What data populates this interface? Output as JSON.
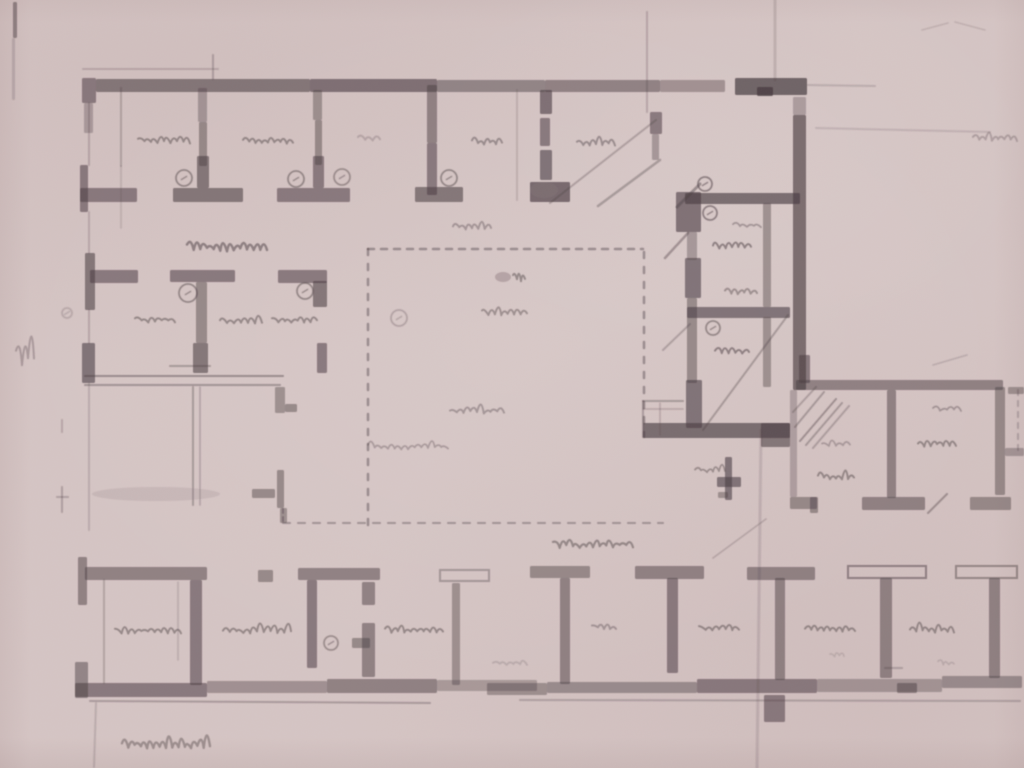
{
  "document": {
    "description": "Faded scanned pencil-and-ink architectural floor plan on pink-tinted paper: a top row of small rooms along a heavy top wall, a gallery corridor, a large central hall outlined with dashed lines, a dark-walled stair/corridor block at right with three small rooms, a right wing of rooms, and a long bottom row of rooms separated by T-shaped pier walls; all handwritten room labels and the lower-left caption are illegible cursive pencil",
    "handwriting_legible": false,
    "caption_note": "illegible cursive title at lower left",
    "label_note": "illegible cursive room labels and circled door symbols throughout"
  },
  "palette": {
    "paper": "#d6c6c5",
    "ink": "#4a3d42",
    "pencil": "#8d7b7e"
  },
  "drawing": {
    "format": {
      "walls": "[x,y,w,h,opacity] filled wall segment",
      "hollow_bars": "[x,y,w,h,opacity] outlined pier bar",
      "lines": "[x1,y1,x2,y2,strokeWidth,opacity] pencil/ink line",
      "dashed_lines": "[x1,y1,x2,y2,strokeWidth,opacity,dash,gap]",
      "circles": "[cx,cy,r,opacity] circled symbol",
      "scribbles": "[x,baselineY,width,height,seed,opacity,strokeWidth] illegible cursive",
      "smudges": "[cx,cy,rx,ry,opacity]"
    },
    "walls": [
      [
        82,
        78,
        14,
        25,
        0.55
      ],
      [
        96,
        79,
        214,
        13,
        0.58
      ],
      [
        310,
        79,
        127,
        13,
        0.62
      ],
      [
        437,
        80,
        108,
        12,
        0.48
      ],
      [
        545,
        80,
        115,
        12,
        0.5
      ],
      [
        660,
        80,
        65,
        12,
        0.38
      ],
      [
        735,
        78,
        72,
        17,
        0.72
      ],
      [
        757,
        87,
        16,
        9,
        0.8
      ],
      [
        84,
        103,
        9,
        30,
        0.3
      ],
      [
        80,
        165,
        8,
        47,
        0.55
      ],
      [
        85,
        253,
        10,
        57,
        0.58
      ],
      [
        82,
        343,
        13,
        40,
        0.6
      ],
      [
        78,
        557,
        9,
        48,
        0.5
      ],
      [
        75,
        662,
        13,
        36,
        0.48
      ],
      [
        80,
        188,
        57,
        14,
        0.55
      ],
      [
        173,
        188,
        70,
        14,
        0.58
      ],
      [
        277,
        188,
        73,
        14,
        0.55
      ],
      [
        415,
        187,
        48,
        15,
        0.58
      ],
      [
        530,
        182,
        40,
        20,
        0.68
      ],
      [
        198,
        88,
        9,
        34,
        0.35
      ],
      [
        199,
        122,
        8,
        44,
        0.45
      ],
      [
        197,
        156,
        12,
        32,
        0.58
      ],
      [
        313,
        90,
        9,
        30,
        0.4
      ],
      [
        315,
        120,
        7,
        45,
        0.45
      ],
      [
        313,
        156,
        11,
        32,
        0.55
      ],
      [
        427,
        85,
        10,
        58,
        0.5
      ],
      [
        427,
        143,
        10,
        52,
        0.55
      ],
      [
        540,
        90,
        12,
        24,
        0.62
      ],
      [
        540,
        118,
        10,
        28,
        0.55
      ],
      [
        540,
        150,
        12,
        30,
        0.6
      ],
      [
        650,
        112,
        12,
        22,
        0.55
      ],
      [
        652,
        134,
        7,
        26,
        0.35
      ],
      [
        90,
        270,
        48,
        13,
        0.55
      ],
      [
        170,
        270,
        65,
        12,
        0.55
      ],
      [
        278,
        270,
        49,
        13,
        0.55
      ],
      [
        313,
        281,
        14,
        26,
        0.58
      ],
      [
        196,
        282,
        11,
        61,
        0.45
      ],
      [
        193,
        343,
        15,
        30,
        0.58
      ],
      [
        317,
        343,
        10,
        30,
        0.55
      ],
      [
        275,
        387,
        10,
        26,
        0.4
      ],
      [
        285,
        404,
        12,
        8,
        0.45
      ],
      [
        277,
        470,
        7,
        38,
        0.45
      ],
      [
        252,
        489,
        23,
        9,
        0.45
      ],
      [
        280,
        508,
        7,
        15,
        0.4
      ],
      [
        85,
        567,
        122,
        13,
        0.5
      ],
      [
        190,
        580,
        12,
        105,
        0.55
      ],
      [
        258,
        570,
        15,
        12,
        0.45
      ],
      [
        298,
        568,
        82,
        12,
        0.5
      ],
      [
        307,
        580,
        10,
        88,
        0.55
      ],
      [
        362,
        582,
        13,
        23,
        0.5
      ],
      [
        362,
        623,
        13,
        54,
        0.5
      ],
      [
        352,
        638,
        18,
        10,
        0.45
      ],
      [
        452,
        583,
        8,
        102,
        0.4
      ],
      [
        530,
        566,
        60,
        12,
        0.45
      ],
      [
        560,
        578,
        10,
        106,
        0.5
      ],
      [
        635,
        566,
        69,
        13,
        0.5
      ],
      [
        667,
        578,
        11,
        95,
        0.55
      ],
      [
        747,
        567,
        68,
        13,
        0.5
      ],
      [
        775,
        578,
        10,
        102,
        0.5
      ],
      [
        880,
        578,
        12,
        100,
        0.5
      ],
      [
        989,
        578,
        11,
        100,
        0.5
      ],
      [
        75,
        683,
        132,
        14,
        0.55
      ],
      [
        207,
        681,
        120,
        12,
        0.38
      ],
      [
        327,
        679,
        110,
        14,
        0.5
      ],
      [
        437,
        680,
        100,
        11,
        0.32
      ],
      [
        487,
        683,
        60,
        12,
        0.4
      ],
      [
        547,
        682,
        150,
        11,
        0.42
      ],
      [
        697,
        679,
        120,
        14,
        0.55
      ],
      [
        817,
        679,
        125,
        13,
        0.35
      ],
      [
        897,
        683,
        20,
        10,
        0.5
      ],
      [
        942,
        676,
        80,
        12,
        0.42
      ],
      [
        764,
        695,
        21,
        27,
        0.55
      ],
      [
        685,
        193,
        115,
        11,
        0.65
      ],
      [
        793,
        115,
        13,
        275,
        0.66
      ],
      [
        793,
        97,
        13,
        18,
        0.3
      ],
      [
        676,
        192,
        25,
        40,
        0.62
      ],
      [
        687,
        232,
        10,
        28,
        0.35
      ],
      [
        685,
        258,
        16,
        40,
        0.6
      ],
      [
        687,
        298,
        10,
        85,
        0.45
      ],
      [
        686,
        380,
        16,
        48,
        0.6
      ],
      [
        687,
        307,
        103,
        11,
        0.6
      ],
      [
        763,
        203,
        8,
        104,
        0.4
      ],
      [
        763,
        317,
        8,
        70,
        0.4
      ],
      [
        643,
        423,
        147,
        15,
        0.65
      ],
      [
        761,
        423,
        29,
        24,
        0.58
      ],
      [
        725,
        457,
        7,
        43,
        0.6
      ],
      [
        717,
        477,
        24,
        10,
        0.6
      ],
      [
        718,
        492,
        10,
        6,
        0.4
      ],
      [
        799,
        355,
        11,
        28,
        0.55
      ],
      [
        796,
        380,
        207,
        10,
        0.5
      ],
      [
        887,
        390,
        9,
        108,
        0.5
      ],
      [
        995,
        387,
        10,
        108,
        0.45
      ],
      [
        1008,
        387,
        16,
        7,
        0.4
      ],
      [
        1005,
        448,
        19,
        8,
        0.35
      ],
      [
        790,
        390,
        7,
        107,
        0.28
      ],
      [
        790,
        497,
        27,
        12,
        0.45
      ],
      [
        810,
        497,
        8,
        16,
        0.45
      ],
      [
        862,
        497,
        63,
        13,
        0.5
      ],
      [
        970,
        497,
        41,
        13,
        0.45
      ],
      [
        13,
        2,
        4,
        36,
        0.5
      ],
      [
        12,
        38,
        3,
        62,
        0.18
      ]
    ],
    "hollow_bars": [
      [
        848,
        566,
        78,
        12,
        0.5
      ],
      [
        956,
        566,
        61,
        12,
        0.45
      ],
      [
        440,
        570,
        49,
        11,
        0.35
      ]
    ],
    "lines": [
      [
        121,
        88,
        121,
        166,
        2,
        0.25
      ],
      [
        121,
        166,
        121,
        228,
        1.5,
        0.16
      ],
      [
        89,
        103,
        89,
        165,
        2,
        0.22
      ],
      [
        89,
        212,
        89,
        253,
        2,
        0.2
      ],
      [
        89,
        310,
        89,
        343,
        2,
        0.22
      ],
      [
        89,
        383,
        89,
        530,
        2,
        0.18
      ],
      [
        83,
        69,
        218,
        69,
        2,
        0.2
      ],
      [
        213,
        55,
        213,
        79,
        2,
        0.28
      ],
      [
        517,
        90,
        517,
        200,
        2,
        0.16
      ],
      [
        647,
        12,
        647,
        112,
        2,
        0.22
      ],
      [
        775,
        0,
        775,
        80,
        3,
        0.16
      ],
      [
        761,
        430,
        757,
        768,
        3,
        0.14
      ],
      [
        816,
        128,
        990,
        132,
        2,
        0.14
      ],
      [
        808,
        85,
        875,
        86,
        2,
        0.18
      ],
      [
        550,
        203,
        656,
        120,
        2,
        0.28
      ],
      [
        598,
        206,
        660,
        160,
        2.5,
        0.32
      ],
      [
        677,
        207,
        700,
        184,
        3,
        0.42
      ],
      [
        665,
        258,
        688,
        233,
        2.5,
        0.38
      ],
      [
        663,
        350,
        690,
        324,
        2,
        0.28
      ],
      [
        703,
        430,
        788,
        315,
        2,
        0.32
      ],
      [
        713,
        558,
        766,
        519,
        1.5,
        0.22
      ],
      [
        800,
        441,
        836,
        399,
        2,
        0.38
      ],
      [
        806,
        445,
        842,
        403,
        2,
        0.32
      ],
      [
        813,
        448,
        849,
        406,
        2,
        0.28
      ],
      [
        795,
        427,
        824,
        392,
        2,
        0.32
      ],
      [
        793,
        412,
        816,
        387,
        2,
        0.28
      ],
      [
        85,
        376,
        283,
        376,
        2,
        0.42
      ],
      [
        85,
        385,
        280,
        385,
        2,
        0.36
      ],
      [
        170,
        366,
        210,
        366,
        2,
        0.32
      ],
      [
        193,
        387,
        193,
        505,
        2,
        0.32
      ],
      [
        200,
        387,
        200,
        505,
        1.5,
        0.26
      ],
      [
        643,
        401,
        683,
        401,
        2,
        0.32
      ],
      [
        643,
        401,
        643,
        437,
        2,
        0.3
      ],
      [
        660,
        403,
        660,
        435,
        1.5,
        0.22
      ],
      [
        643,
        409,
        683,
        409,
        1.5,
        0.22
      ],
      [
        928,
        513,
        947,
        494,
        2,
        0.38
      ],
      [
        933,
        365,
        967,
        355,
        1.5,
        0.18
      ],
      [
        922,
        30,
        948,
        23,
        1.5,
        0.15
      ],
      [
        955,
        22,
        985,
        30,
        1.5,
        0.15
      ],
      [
        90,
        701,
        430,
        703,
        2,
        0.3
      ],
      [
        520,
        700,
        1020,
        701,
        2,
        0.26
      ],
      [
        104,
        580,
        104,
        683,
        2,
        0.24
      ],
      [
        178,
        582,
        178,
        660,
        1.5,
        0.18
      ],
      [
        62,
        487,
        62,
        512,
        2,
        0.28
      ],
      [
        57,
        497,
        68,
        497,
        2,
        0.26
      ],
      [
        62,
        420,
        62,
        432,
        2,
        0.22
      ],
      [
        96,
        703,
        94,
        767,
        2,
        0.18
      ],
      [
        885,
        668,
        902,
        668,
        2,
        0.26
      ]
    ],
    "dashed_lines": [
      [
        368,
        249,
        643,
        249,
        2.5,
        0.42,
        6,
        7
      ],
      [
        368,
        249,
        368,
        530,
        2.5,
        0.42,
        6,
        9
      ],
      [
        644,
        252,
        644,
        437,
        2.5,
        0.42,
        6,
        9
      ],
      [
        283,
        523,
        663,
        523,
        2,
        0.36,
        7,
        8
      ],
      [
        283,
        509,
        283,
        523,
        2,
        0.38,
        4,
        4
      ],
      [
        1018,
        390,
        1018,
        452,
        2,
        0.26,
        5,
        6
      ]
    ],
    "circles": [
      [
        184,
        178,
        8,
        0.45
      ],
      [
        296,
        179,
        8,
        0.45
      ],
      [
        342,
        177,
        8,
        0.4
      ],
      [
        449,
        178,
        8,
        0.45
      ],
      [
        188,
        293,
        9,
        0.45
      ],
      [
        305,
        291,
        8,
        0.45
      ],
      [
        705,
        184,
        7,
        0.5
      ],
      [
        710,
        213,
        7,
        0.5
      ],
      [
        713,
        328,
        7,
        0.45
      ],
      [
        331,
        643,
        7,
        0.4
      ],
      [
        399,
        318,
        8,
        0.25
      ],
      [
        67,
        313,
        5,
        0.2
      ]
    ],
    "scribbles": [
      [
        138,
        142,
        52,
        10,
        11,
        0.45,
        2
      ],
      [
        243,
        142,
        50,
        10,
        12,
        0.45,
        2
      ],
      [
        358,
        140,
        22,
        7,
        13,
        0.22,
        2
      ],
      [
        472,
        143,
        30,
        9,
        14,
        0.42,
        2
      ],
      [
        577,
        144,
        38,
        9,
        15,
        0.42,
        2
      ],
      [
        973,
        140,
        44,
        9,
        16,
        0.28,
        2
      ],
      [
        187,
        249,
        80,
        13,
        17,
        0.5,
        2.5
      ],
      [
        135,
        321,
        40,
        9,
        18,
        0.45,
        2
      ],
      [
        220,
        323,
        42,
        9,
        19,
        0.45,
        2
      ],
      [
        272,
        321,
        45,
        9,
        20,
        0.45,
        2
      ],
      [
        733,
        226,
        28,
        7,
        21,
        0.35,
        1.8
      ],
      [
        713,
        247,
        38,
        9,
        22,
        0.5,
        2
      ],
      [
        725,
        293,
        32,
        8,
        23,
        0.4,
        2
      ],
      [
        715,
        352,
        34,
        9,
        24,
        0.5,
        2
      ],
      [
        453,
        228,
        38,
        8,
        25,
        0.35,
        2
      ],
      [
        482,
        314,
        45,
        9,
        26,
        0.4,
        2
      ],
      [
        450,
        412,
        54,
        9,
        27,
        0.35,
        2
      ],
      [
        368,
        448,
        80,
        8,
        28,
        0.3,
        1.8
      ],
      [
        513,
        279,
        12,
        15,
        29,
        0.45,
        2
      ],
      [
        695,
        471,
        30,
        7,
        30,
        0.4,
        1.8
      ],
      [
        822,
        445,
        28,
        7,
        31,
        0.3,
        1.8
      ],
      [
        818,
        478,
        36,
        9,
        32,
        0.45,
        2
      ],
      [
        933,
        410,
        28,
        7,
        33,
        0.35,
        1.8
      ],
      [
        918,
        445,
        38,
        9,
        34,
        0.45,
        2
      ],
      [
        553,
        546,
        80,
        11,
        35,
        0.45,
        2.2
      ],
      [
        115,
        632,
        66,
        9,
        36,
        0.45,
        2
      ],
      [
        223,
        632,
        68,
        9,
        37,
        0.45,
        2
      ],
      [
        385,
        632,
        58,
        9,
        38,
        0.45,
        2
      ],
      [
        592,
        628,
        24,
        8,
        39,
        0.35,
        2
      ],
      [
        699,
        630,
        40,
        9,
        40,
        0.45,
        2
      ],
      [
        805,
        630,
        50,
        9,
        41,
        0.45,
        2
      ],
      [
        910,
        631,
        44,
        9,
        42,
        0.45,
        2
      ],
      [
        122,
        746,
        88,
        13,
        43,
        0.4,
        2.4
      ],
      [
        16,
        360,
        18,
        30,
        44,
        0.3,
        2
      ],
      [
        493,
        664,
        34,
        7,
        45,
        0.18,
        1.8
      ],
      [
        938,
        664,
        16,
        6,
        46,
        0.18,
        1.5
      ],
      [
        830,
        656,
        14,
        6,
        47,
        0.16,
        1.5
      ]
    ],
    "smudges": [
      [
        156,
        494,
        64,
        7,
        0.18
      ],
      [
        503,
        277,
        8,
        5,
        0.45
      ],
      [
        544,
        190,
        14,
        8,
        0.25
      ]
    ]
  }
}
